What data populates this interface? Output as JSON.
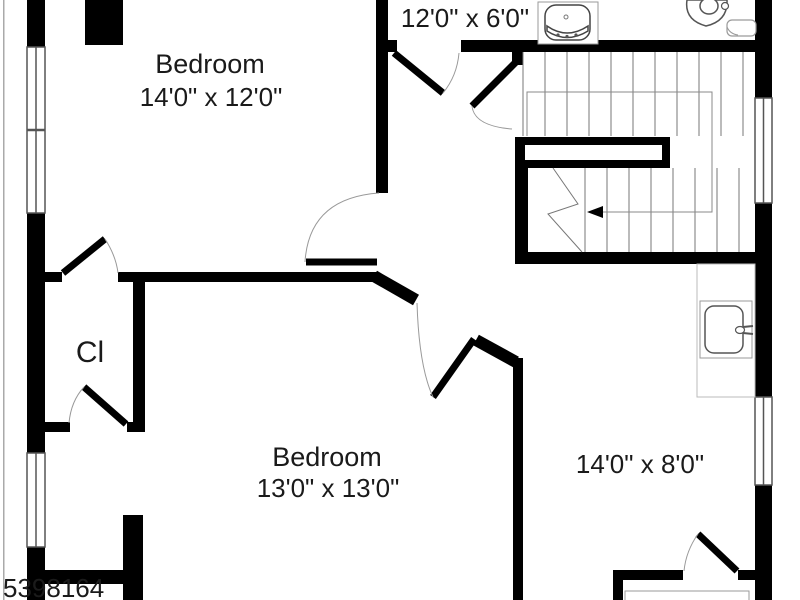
{
  "floorplan": {
    "watermark": "5398164",
    "rooms": [
      {
        "id": "bedroom-1",
        "label": "Bedroom",
        "dimensions": "14'0\" x 12'0\""
      },
      {
        "id": "bathroom-top",
        "label": "",
        "dimensions": "12'0\" x 6'0\""
      },
      {
        "id": "closet",
        "label": "Cl",
        "dimensions": ""
      },
      {
        "id": "bedroom-2",
        "label": "Bedroom",
        "dimensions": "13'0\" x 13'0\""
      },
      {
        "id": "bonus-room",
        "label": "",
        "dimensions": "14'0\" x 8'0\""
      }
    ],
    "fixtures": [
      "vanity-sink",
      "toilet",
      "bathroom-sink",
      "staircase",
      "stair-direction-arrow"
    ],
    "colors": {
      "wall": "#000000",
      "background": "#ffffff",
      "fixture_outline": "#8c8c8c",
      "stair_line": "#777777",
      "text": "#1a1a1a"
    }
  }
}
